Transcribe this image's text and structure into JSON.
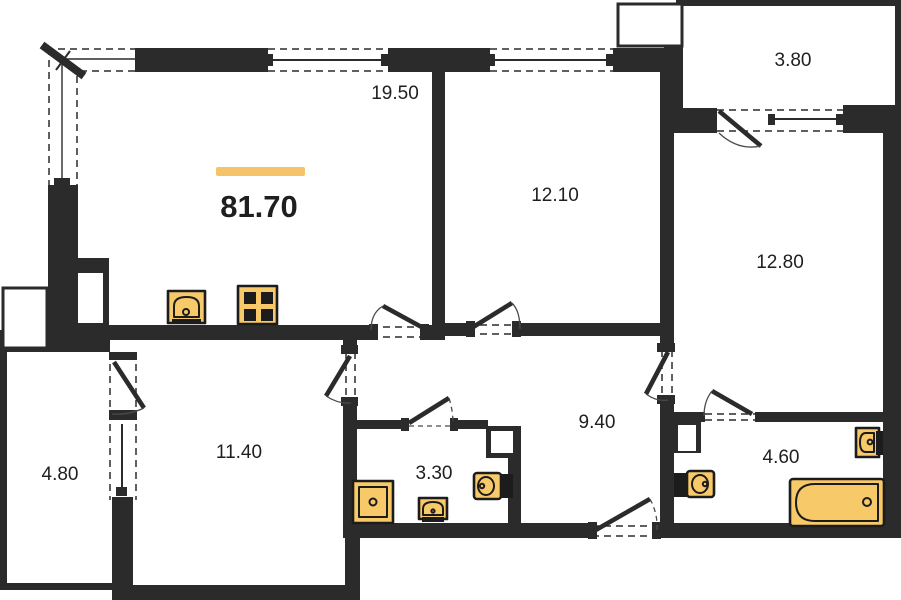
{
  "plan": {
    "total_area": "81.70",
    "type": "apartment-floor-plan"
  },
  "rooms": [
    {
      "id": "living-kitchen",
      "area": "19.50"
    },
    {
      "id": "bedroom-top",
      "area": "12.10"
    },
    {
      "id": "balcony-top",
      "area": "3.80"
    },
    {
      "id": "bedroom-right",
      "area": "12.80"
    },
    {
      "id": "balcony-left",
      "area": "4.80"
    },
    {
      "id": "bedroom-left",
      "area": "11.40"
    },
    {
      "id": "bathroom-small",
      "area": "3.30"
    },
    {
      "id": "hallway",
      "area": "9.40"
    },
    {
      "id": "bathroom-large",
      "area": "4.60"
    }
  ],
  "fixtures": [
    "kitchen-sink",
    "stove",
    "shower-tray",
    "washbasin-small",
    "toilet-small-bath",
    "toilet-large-bath",
    "washbasin-large-bath",
    "bathtub"
  ],
  "colors": {
    "wall": "#2b2b2b",
    "ink": "#1f1f1f",
    "fixture": "#f8c968",
    "fixline": "#1c1c1c",
    "accent": "#f5c469",
    "bg": "#ffffff"
  }
}
